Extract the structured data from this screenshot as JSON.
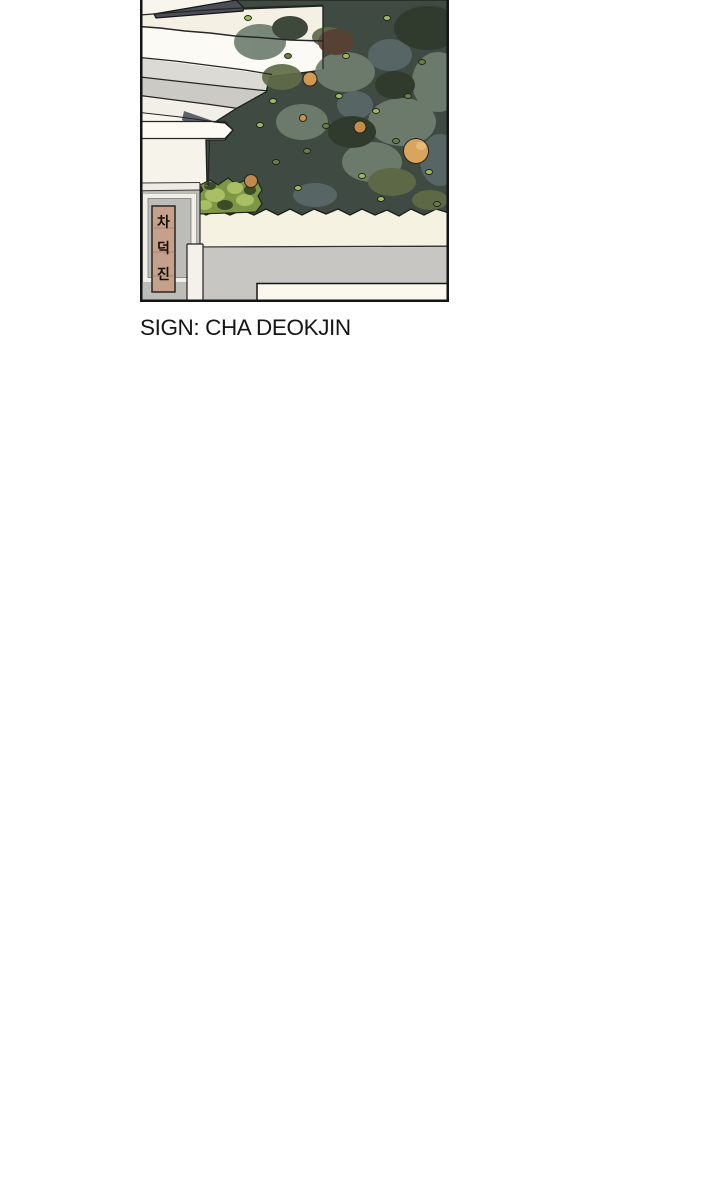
{
  "caption": {
    "text": "SIGN: CHA DEOKJIN",
    "color": "#161616"
  },
  "panel": {
    "kind": "webtoon-comic-panel",
    "border_color": "#141414",
    "background_color": "#f7f5ec",
    "sign": {
      "full_text": "차덕진",
      "characters": [
        "차",
        "덕",
        "진"
      ],
      "board_color": "#c5a08b",
      "text_color": "#181008",
      "border_color": "#2b241e"
    },
    "palette": {
      "roof_slate": "#4b4e57",
      "eave_cream": "#f4f1e4",
      "eave_white": "#fbfaf4",
      "eave_gray": "#cbcac4",
      "foliage_dark": "#3e4a42",
      "foliage_sage": "#6f7f6f",
      "foliage_olive": "#5f6b47",
      "foliage_bright": "#7d9747",
      "leaf_highlight": "#a2b75e",
      "fruit_orange": "#d49950",
      "fruit_orange_large": "#d9a45c",
      "wall_cream_band": "#f5f2e2",
      "wall_gray_band": "#c7c6c2",
      "post_gray": "#bcbcb8",
      "step_white": "#faf8ef"
    }
  }
}
